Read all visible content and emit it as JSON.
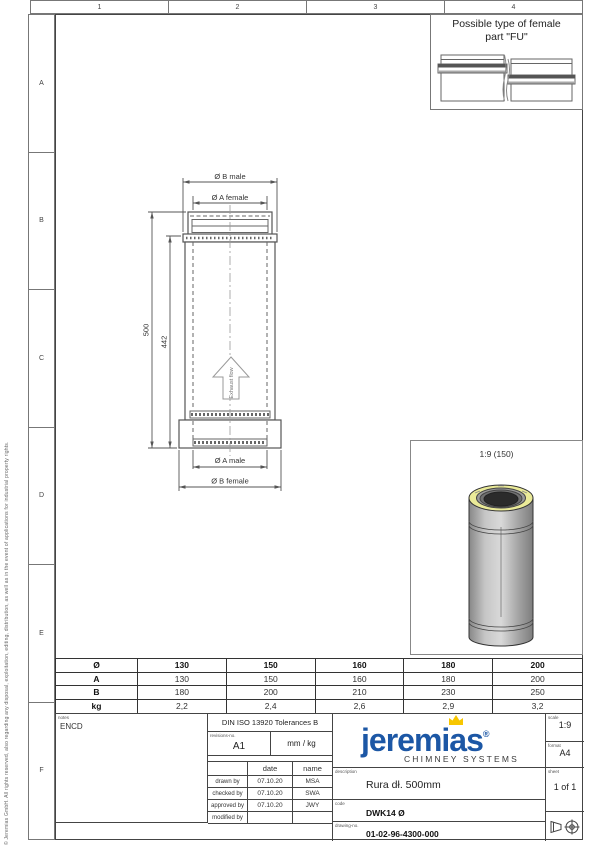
{
  "sheet": {
    "copyright": "© Jeremias GmbH. All rights reserved, also regarding any disposal, exploitation, editing, distribution, as well as in the event of applications for industrial property rights.",
    "grid_columns": [
      "1",
      "2",
      "3",
      "4"
    ],
    "grid_rows": [
      "A",
      "B",
      "C",
      "D",
      "E",
      "F"
    ]
  },
  "female_part_box": {
    "title_line1": "Possible type of female",
    "title_line2": "part \"FU\""
  },
  "main_drawing": {
    "dim_top_outer": "Ø B male",
    "dim_top_inner": "Ø A female",
    "dim_length_total": "500",
    "dim_length_inner": "442",
    "dim_bottom_inner": "Ø A male",
    "dim_bottom_outer": "Ø B female",
    "flow_label": "Exhaust flow"
  },
  "detail_view": {
    "scale_label": "1:9 (150)"
  },
  "dimension_table": {
    "rows": [
      {
        "label": "Ø",
        "values": [
          "130",
          "150",
          "160",
          "180",
          "200"
        ]
      },
      {
        "label": "A",
        "values": [
          "130",
          "150",
          "160",
          "180",
          "200"
        ]
      },
      {
        "label": "B",
        "values": [
          "180",
          "200",
          "210",
          "230",
          "250"
        ]
      },
      {
        "label": "kg",
        "values": [
          "2,2",
          "2,4",
          "2,6",
          "2,9",
          "3,2"
        ]
      }
    ]
  },
  "title_block": {
    "notes_label": "notes",
    "notes_value": "ENCD",
    "tolerances": "DIN ISO 13920 Tolerances B",
    "revisions_label": "revisions-no.",
    "revision_no": "A1",
    "units": "mm / kg",
    "date_header": "date",
    "name_header": "name",
    "signature_rows": [
      {
        "label": "drawn by",
        "date": "07.10.20",
        "name": "MSA"
      },
      {
        "label": "checked by",
        "date": "07.10.20",
        "name": "SWA"
      },
      {
        "label": "approved by",
        "date": "07.10.20",
        "name": "JWY"
      },
      {
        "label": "modified by",
        "date": "",
        "name": ""
      }
    ],
    "brand": {
      "wordmark": "jeremias",
      "registered": "®",
      "tagline": "CHIMNEY SYSTEMS",
      "blue": "#1c57a5",
      "gold": "#f7c600"
    },
    "description_label": "description",
    "description": "Rura dł. 500mm",
    "code_label": "code",
    "code": "DWK14  Ø",
    "drawing_no_label": "drawing-no.",
    "drawing_no": "01-02-96-4300-000",
    "scale_label": "scale",
    "scale": "1:9",
    "format_label": "format",
    "format": "A4",
    "sheet_label": "sheet",
    "sheet": "1 of 1"
  }
}
